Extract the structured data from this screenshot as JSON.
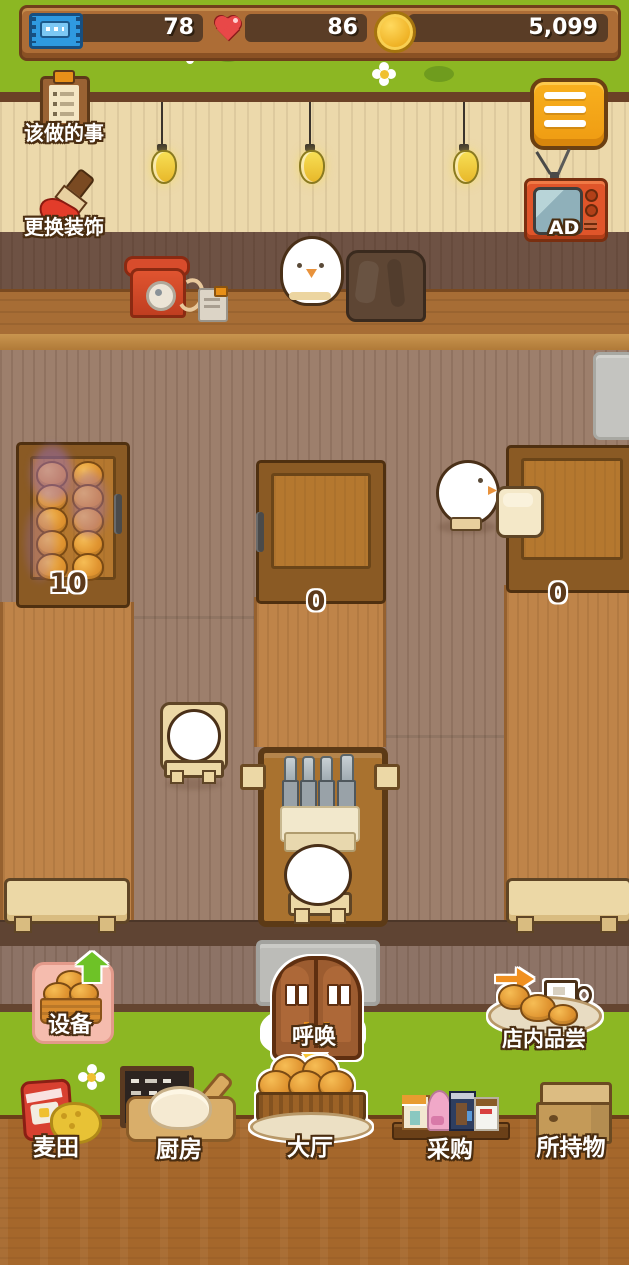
{
  "hud": {
    "ticket_count": "78",
    "heart_count": "86",
    "coin_count": "5,099"
  },
  "top_buttons": {
    "todo_label": "该做的事",
    "decorate_label": "更换装饰",
    "ad_label": "AD"
  },
  "shop": {
    "displays": [
      {
        "position": "left",
        "count": "10"
      },
      {
        "position": "middle",
        "count": "0"
      },
      {
        "position": "right",
        "count": "0"
      }
    ]
  },
  "action_buttons": {
    "equipment_label": "设备",
    "call_label": "呼唤",
    "tasting_label": "店内品尝"
  },
  "nav": {
    "tabs": [
      {
        "id": "wheat-field",
        "label": "麦田",
        "selected": false
      },
      {
        "id": "kitchen",
        "label": "厨房",
        "selected": false
      },
      {
        "id": "hall",
        "label": "大厅",
        "selected": true
      },
      {
        "id": "purchase",
        "label": "采购",
        "selected": false
      },
      {
        "id": "inventory",
        "label": "所持物",
        "selected": false
      }
    ]
  },
  "colors": {
    "grass": "#8cb723",
    "accent_orange": "#f5a81e",
    "wood_dark": "#5f4433",
    "hud_panel": "#5a3d26"
  }
}
